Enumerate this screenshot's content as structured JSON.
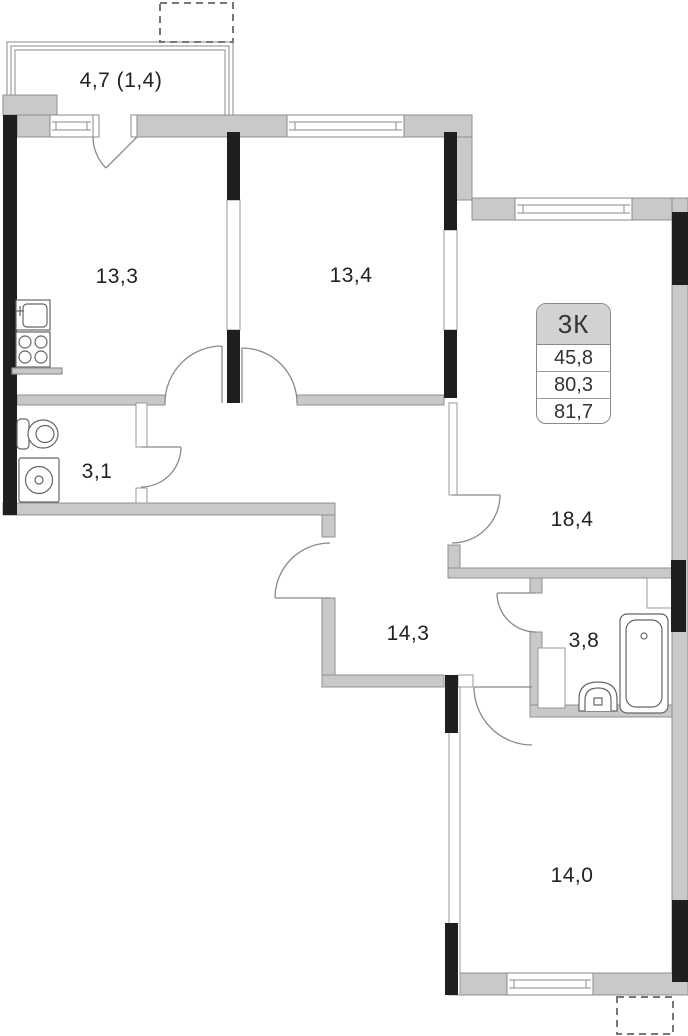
{
  "plan": {
    "info_box": {
      "type_label": "3К",
      "rows": [
        "45,8",
        "80,3",
        "81,7"
      ]
    },
    "rooms": [
      {
        "id": "balcony",
        "label": "4,7 (1,4)"
      },
      {
        "id": "kitchen",
        "label": "13,3"
      },
      {
        "id": "bedroom-1",
        "label": "13,4"
      },
      {
        "id": "wc-small",
        "label": "3,1"
      },
      {
        "id": "living-room",
        "label": "18,4"
      },
      {
        "id": "hallway",
        "label": "14,3"
      },
      {
        "id": "bathroom",
        "label": "3,8"
      },
      {
        "id": "bedroom-2",
        "label": "14,0"
      }
    ],
    "colors": {
      "wall_fill": "#c9c9c9",
      "wall_load_bearing": "#1f1f1f",
      "outline": "#8a8a8a",
      "text": "#222222",
      "info_header_bg": "#d2d2d2"
    }
  }
}
